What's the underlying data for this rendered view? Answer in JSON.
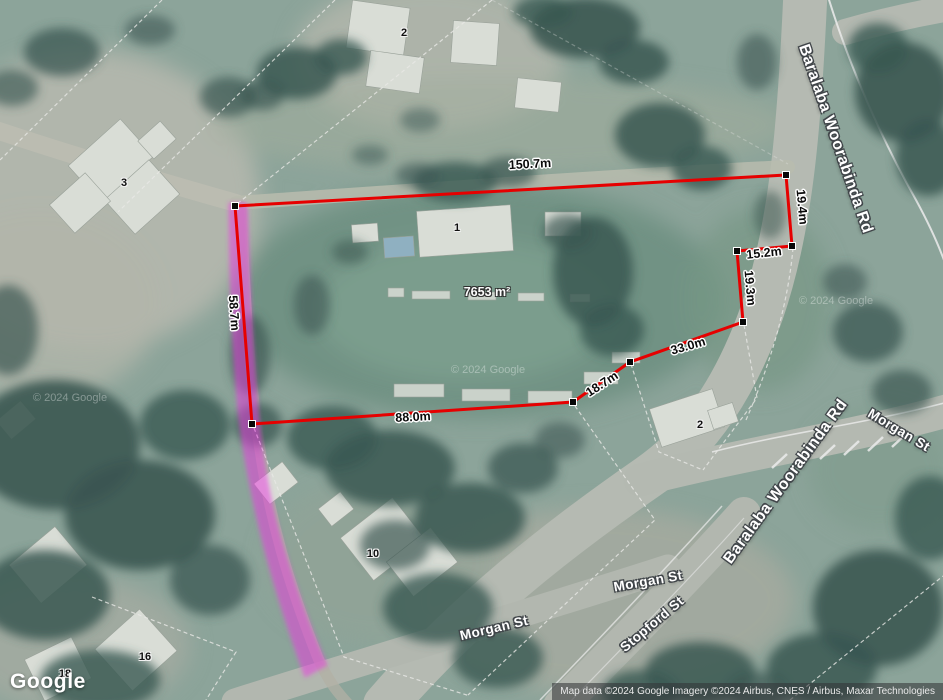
{
  "map": {
    "watermark": "© 2024 Google",
    "google_logo": "Google",
    "attribution": "Map data ©2024 Google Imagery ©2024 Airbus, CNES / Airbus, Maxar Technologies"
  },
  "parcel": {
    "area_label": "7653 m²",
    "outline_color": "#e60000",
    "highlight_color": "#e83adf",
    "measurements": {
      "top": "150.7m",
      "right_upper": "19.4m",
      "notch_top": "15.2m",
      "notch_right": "19.3m",
      "southeast_upper": "33.0m",
      "southeast_lower": "18.7m",
      "bottom": "88.0m",
      "west": "58.7m"
    }
  },
  "roads": {
    "baralaba_north": "Baralaba Woorabinda Rd",
    "baralaba_south": "Baralaba Woorabinda Rd",
    "morgan_east": "Morgan St",
    "morgan_mid": "Morgan St",
    "morgan_west": "Morgan St",
    "stopford": "Stopford St"
  },
  "lot_numbers": {
    "north": "2",
    "west": "3",
    "hall": "1",
    "east": "2",
    "south": "10",
    "southwest_a": "16",
    "southwest_b": "18"
  }
}
